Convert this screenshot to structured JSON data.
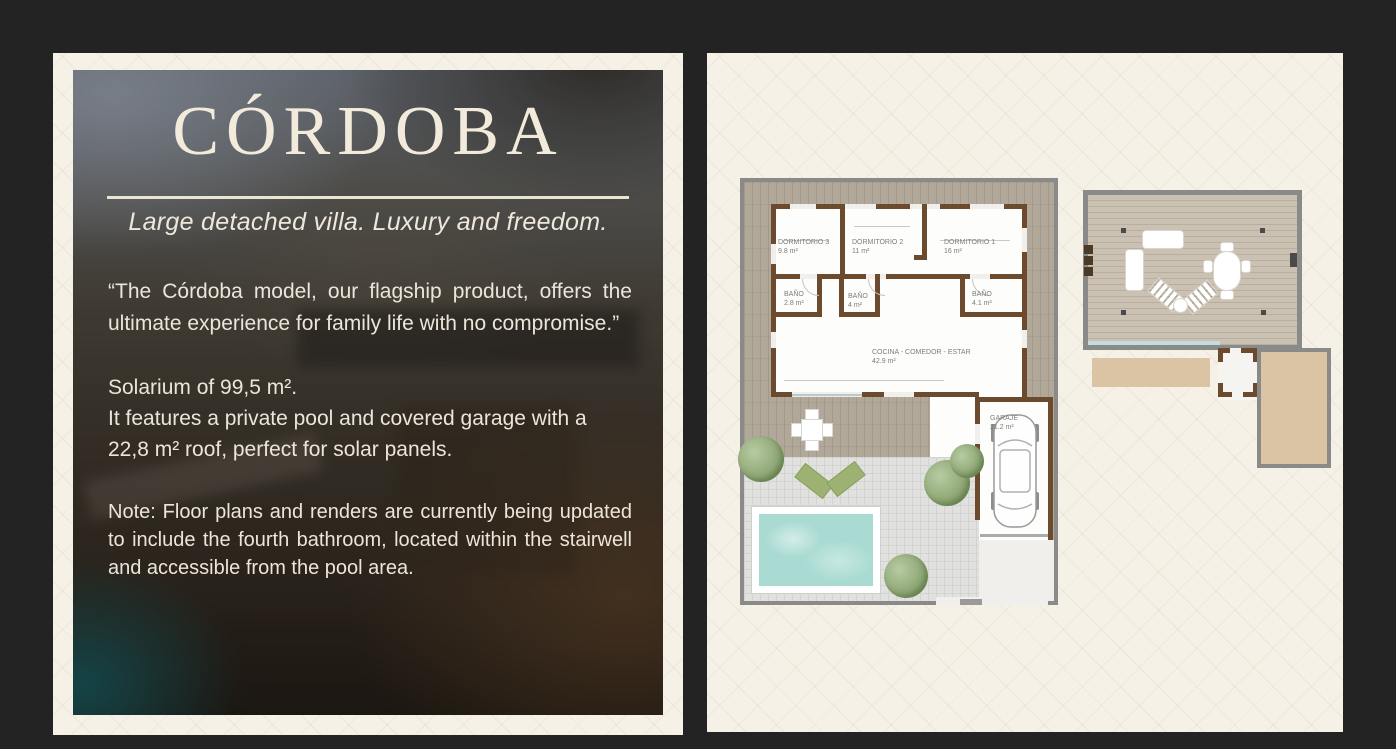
{
  "left_panel": {
    "title": "CÓRDOBA",
    "subtitle": "Large detached villa. Luxury and freedom.",
    "quote": "“The Córdoba model, our flagship product, offers the ultimate experience for family life with no compromise.”",
    "solarium_lines": [
      "Solarium of 99,5 m².",
      "It features a private pool and covered garage with a",
      "22,8 m² roof, perfect for solar panels."
    ],
    "note": "Note: Floor plans and renders are currently being updated to include the fourth bathroom, located within the stairwell and accessible from the pool area."
  },
  "floor_plan": {
    "rooms": {
      "dormitorio3": {
        "name": "DORMITORIO 3",
        "area": "9.8 m²"
      },
      "dormitorio2": {
        "name": "DORMITORIO 2",
        "area": "11 m²"
      },
      "dormitorio1": {
        "name": "DORMITORIO 1",
        "area": "16 m²"
      },
      "bano_a": {
        "name": "BAÑO",
        "area": "2.8 m²"
      },
      "bano_b": {
        "name": "BAÑO",
        "area": "4 m²"
      },
      "bano_c": {
        "name": "BAÑO",
        "area": "4.1 m²"
      },
      "cocina": {
        "name": "COCINA - COMEDOR - ESTAR",
        "area": "42.9 m²"
      },
      "garaje": {
        "name": "GARAJE",
        "area": "21.2 m²"
      }
    }
  },
  "colors": {
    "page_background": "#232323",
    "card_cream": "#f6f1e7",
    "title_cream": "#f2ebdb",
    "wall_brown": "#6b4a2e",
    "plan_border_gray": "#8a8a88",
    "deck_wood": "#b2a89a",
    "solarium_wood": "#cbc1b3",
    "patio_tile": "#e1e1e0",
    "pool_water": "#a9dbd3",
    "plant_green": "#8fa876",
    "roof_tan": "#dac4a4"
  }
}
